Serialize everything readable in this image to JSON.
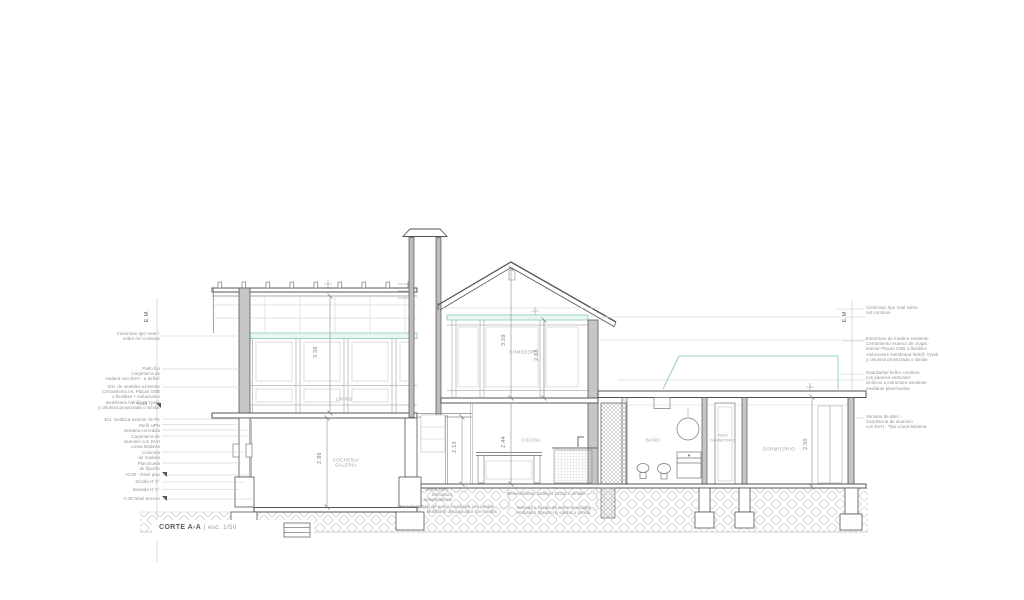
{
  "drawing": {
    "title": {
      "name": "CORTE A-A",
      "separator": "|",
      "scale": "esc. 1/50"
    },
    "axis_left": "E.M.",
    "axis_right": "E.M."
  },
  "rooms": {
    "living": "LIVING",
    "cochera": "COCHERA/\nGALERÍA",
    "comedor": "COMEDOR",
    "cocina": "COCINA",
    "bano": "BAÑO",
    "paso": "PASO\nDORMITORIO",
    "dormitorio": "DORMITORIO"
  },
  "dimensions": {
    "living_height": "3.56",
    "cochera_height": "2.86",
    "comedor_total_height": "3.59",
    "comedor_height": "2.68",
    "pasillo_height": "2.13",
    "cocina_height": "2.44",
    "dormitorio_height": "2.50"
  },
  "annotations": {
    "left": [
      "Cielorraso tipo Vual +\nsobre riel continuo",
      "Paño fijo\nCarpintería de\nmadera con DVH - a definir",
      "Est. de muebles existente\nCerramiento int. Placas OSB\no flexibles + Aislaciones\nmembrana hidrófuga Tyvek\ny celulosa proyectada o similar",
      "+4.10",
      "Est. metálica exterior de PA",
      "Perfil UPN",
      "Ventana corrediza",
      "Carpintería de\naluminio con DVH\nLínea Módena",
      "Columna\nde madera",
      "Planchuela\nde fijación",
      "+0.90 - Nivel piso",
      "Zócalo H°A°",
      "Mesada H°A°",
      "-0.30 Nivel terreno"
    ],
    "right": [
      "Cielorraso tipo Vual sobre\nriel continuo",
      "Estructura de madera existente\nCerramiento exterior de chapa\ninterior Placas OSB o flexibles\nAislaciones membrana hidróf. Tyvek\ny celulosa proyectada o similar",
      "Guardarriel fieltro continuo\ncon paneles verticales\nvinílicos a estructura existente\nmediante planchuelas",
      "Ventana de abrir -\nCarpintería de aluminio\ncon DVH - Tipo Línea Módena"
    ],
    "bottom": [
      "Horno exist. -\nestructura\nindependiente",
      "Mesa de trabajo de acero inoxidable con ruedas -\nMobiliario desayunador con ruedas",
      "Revestimiento azulejos 15x15 o similar",
      "Mesada y zócalo de acero inoxidable -\nMobiliario (diseño) a validar o similar"
    ]
  },
  "colors": {
    "accent_teal": "#96d0c1",
    "line_dark": "#555555",
    "text_gray": "#8f8f8f"
  }
}
